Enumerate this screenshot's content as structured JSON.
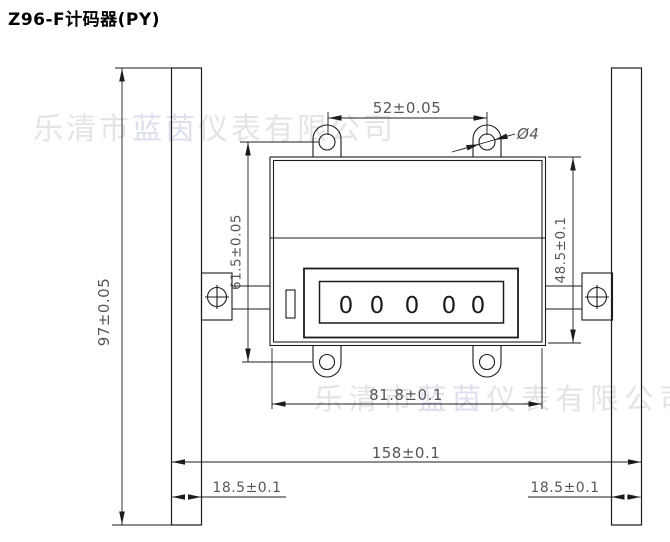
{
  "title": "Z96-F计码器(PY)",
  "watermark": {
    "prefix": "乐清市",
    "brand": "蓝茵",
    "suffix": "仪表有限公司",
    "full": "乐清市蓝茵仪表有限公司"
  },
  "counter_display": {
    "digits": [
      "0",
      "0",
      "0",
      "0",
      "0"
    ]
  },
  "dimensions": {
    "mounting_hole_spacing": "52±0.05",
    "mounting_hole_diameter": "Ø4",
    "hole_center_height": "61.5±0.05",
    "body_height": "48.5±0.1",
    "overall_height": "97±0.05",
    "body_width": "81.8±0.1",
    "overall_width": "158±0.1",
    "rail_offset_left": "18.5±0.1",
    "rail_offset_right": "18.5±0.1"
  },
  "colors": {
    "line": "#1c1c1c",
    "dim_text": "#565656",
    "watermark": "#e4e4e4",
    "watermark_brand": "#dcdff0",
    "background": "#ffffff",
    "title_text": "#000000"
  }
}
